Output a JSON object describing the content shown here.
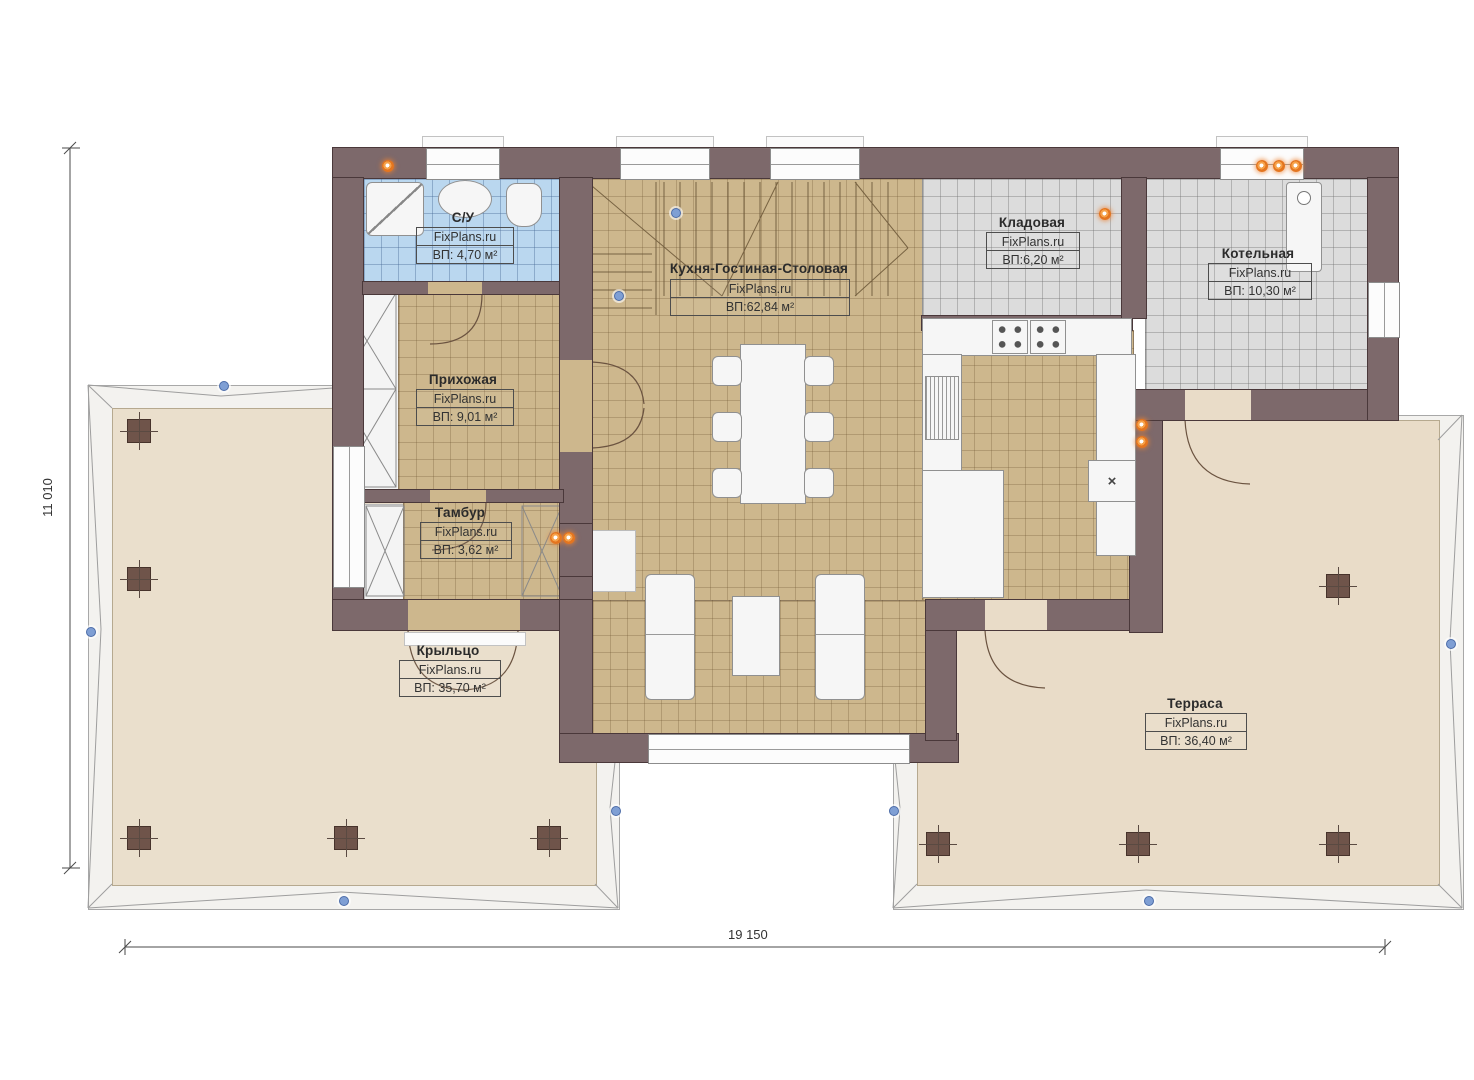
{
  "plan": {
    "watermark": "FixPlans.ru",
    "rooms": [
      {
        "name": "С/У",
        "area": "ВП: 4,70 м²"
      },
      {
        "name": "Прихожая",
        "area": "ВП: 9,01 м²"
      },
      {
        "name": "Тамбур",
        "area": "ВП: 3,62 м²"
      },
      {
        "name": "Кухня-Гостиная-Столовая",
        "area": "ВП:62,84 м²"
      },
      {
        "name": "Кладовая",
        "area": "ВП:6,20 м²"
      },
      {
        "name": "Котельная",
        "area": "ВП: 10,30 м²"
      },
      {
        "name": "Крыльцо",
        "area": "ВП: 35,70 м²"
      },
      {
        "name": "Терраса",
        "area": "ВП: 36,40 м²"
      }
    ],
    "dimensions": {
      "total_width": "19 150",
      "total_height": "11 010"
    },
    "symbols": {
      "kitchen_marker": "×"
    },
    "colors": {
      "wall": "#7d696b",
      "tile_tan": "#cdb78d",
      "tile_blue": "#bad7ef",
      "tile_gray": "#dcdcdc",
      "deck": "#e9dcc8",
      "lamp_accent": "#e4751f"
    }
  }
}
